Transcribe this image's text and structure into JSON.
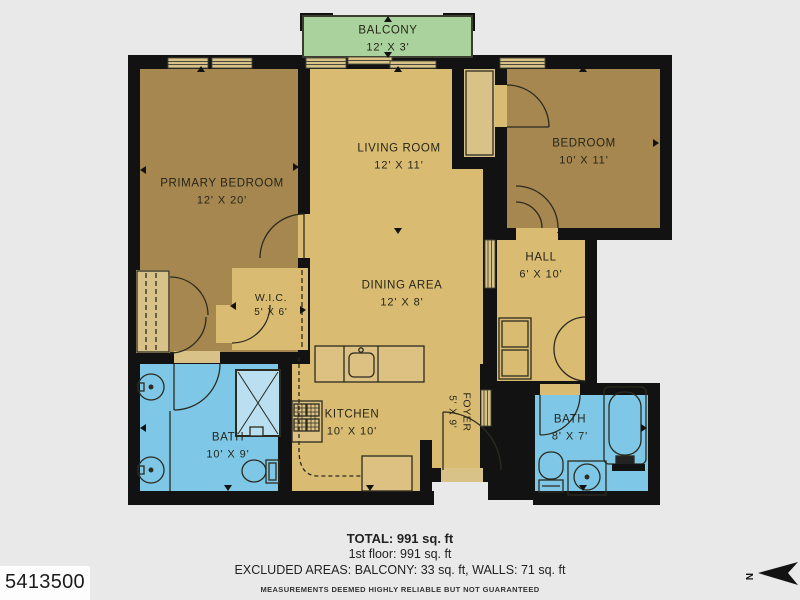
{
  "floorplan": {
    "rooms": {
      "balcony": {
        "name": "BALCONY",
        "dims": "12' X 3'"
      },
      "primary_bedroom": {
        "name": "PRIMARY BEDROOM",
        "dims": "12' X 20'"
      },
      "living_room": {
        "name": "LIVING ROOM",
        "dims": "12' X 11'"
      },
      "bedroom": {
        "name": "BEDROOM",
        "dims": "10' X 11'"
      },
      "hall": {
        "name": "HALL",
        "dims": "6' X 10'"
      },
      "dining_area": {
        "name": "DINING AREA",
        "dims": "12' X 8'"
      },
      "wic": {
        "name": "W.I.C.",
        "dims": "5' X 6'"
      },
      "kitchen": {
        "name": "KITCHEN",
        "dims": "10' X 10'"
      },
      "foyer": {
        "name": "FOYER",
        "dims": "5' X 9'"
      },
      "bath_left": {
        "name": "BATH",
        "dims": "10' X 9'"
      },
      "bath_right": {
        "name": "BATH",
        "dims": "8' X 7'"
      }
    }
  },
  "footer": {
    "total": "TOTAL: 991 sq. ft",
    "floor": "1st floor: 991 sq. ft",
    "excluded": "EXCLUDED AREAS: BALCONY: 33 sq. ft, WALLS: 71 sq. ft",
    "disclaimer": "MEASUREMENTS DEEMED HIGHLY RELIABLE BUT NOT GUARANTEED"
  },
  "listing_id": "5413500",
  "compass": {
    "label": "N"
  },
  "icons": {
    "north_arrow": "north-arrow-icon",
    "door_arc": "door-swing-icon",
    "window": "window-glyph"
  },
  "colors": {
    "bg": "#e9e9e9",
    "wall": "#121212",
    "bedroom": "#a5874f",
    "living": "#d9bc72",
    "bath": "#7fc7e6",
    "balcony": "#a9d29c",
    "closet": "#d9c287"
  }
}
